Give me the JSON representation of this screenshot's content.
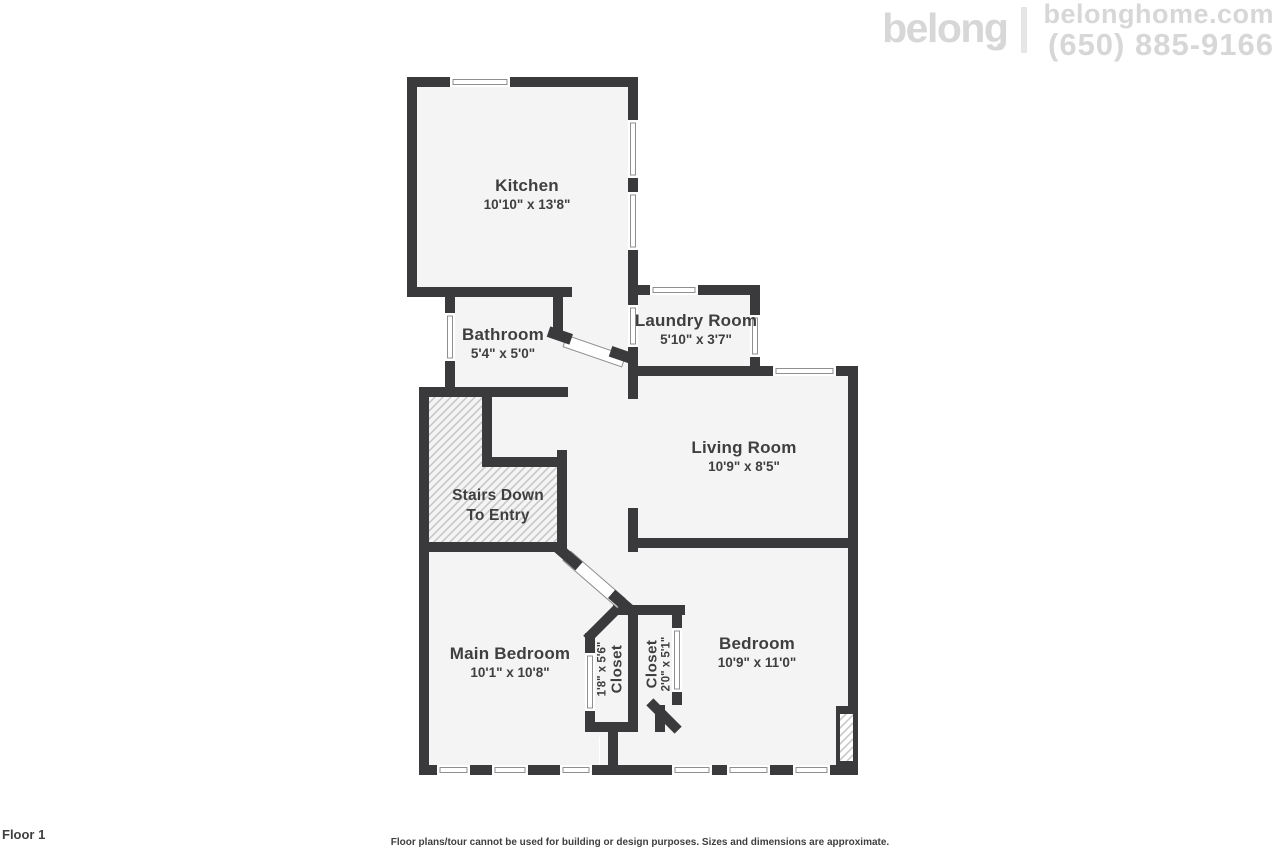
{
  "colors": {
    "wall": "#3a3a3c",
    "floor": "#f4f4f4",
    "hatch-line": "#c8c8c8",
    "label-text": "#3f3f3f",
    "brand-gray": "#d7d7d7",
    "window-stroke": "#8f8f8f"
  },
  "header": {
    "logo_text": "belong",
    "website": "belonghome.com",
    "phone": "(650) 885-9166"
  },
  "rooms": {
    "kitchen": {
      "name": "Kitchen",
      "dims": "10'10\" x 13'8\""
    },
    "bathroom": {
      "name": "Bathroom",
      "dims": "5'4\" x 5'0\""
    },
    "laundry": {
      "name": "Laundry Room",
      "dims": "5'10\" x 3'7\""
    },
    "living": {
      "name": "Living Room",
      "dims": "10'9\" x 8'5\""
    },
    "stairs": {
      "line1": "Stairs Down",
      "line2": "To Entry"
    },
    "main_bedroom": {
      "name": "Main Bedroom",
      "dims": "10'1\" x 10'8\""
    },
    "closet1": {
      "name": "Closet",
      "dims": "1'8\" x 5'6\""
    },
    "closet2": {
      "name": "Closet",
      "dims": "2'0\" x 5'1\""
    },
    "bedroom": {
      "name": "Bedroom",
      "dims": "10'9\" x 11'0\""
    }
  },
  "footer": {
    "floor_label": "Floor 1",
    "disclaimer": "Floor plans/tour cannot be used for building or design purposes. Sizes and dimensions are approximate."
  }
}
